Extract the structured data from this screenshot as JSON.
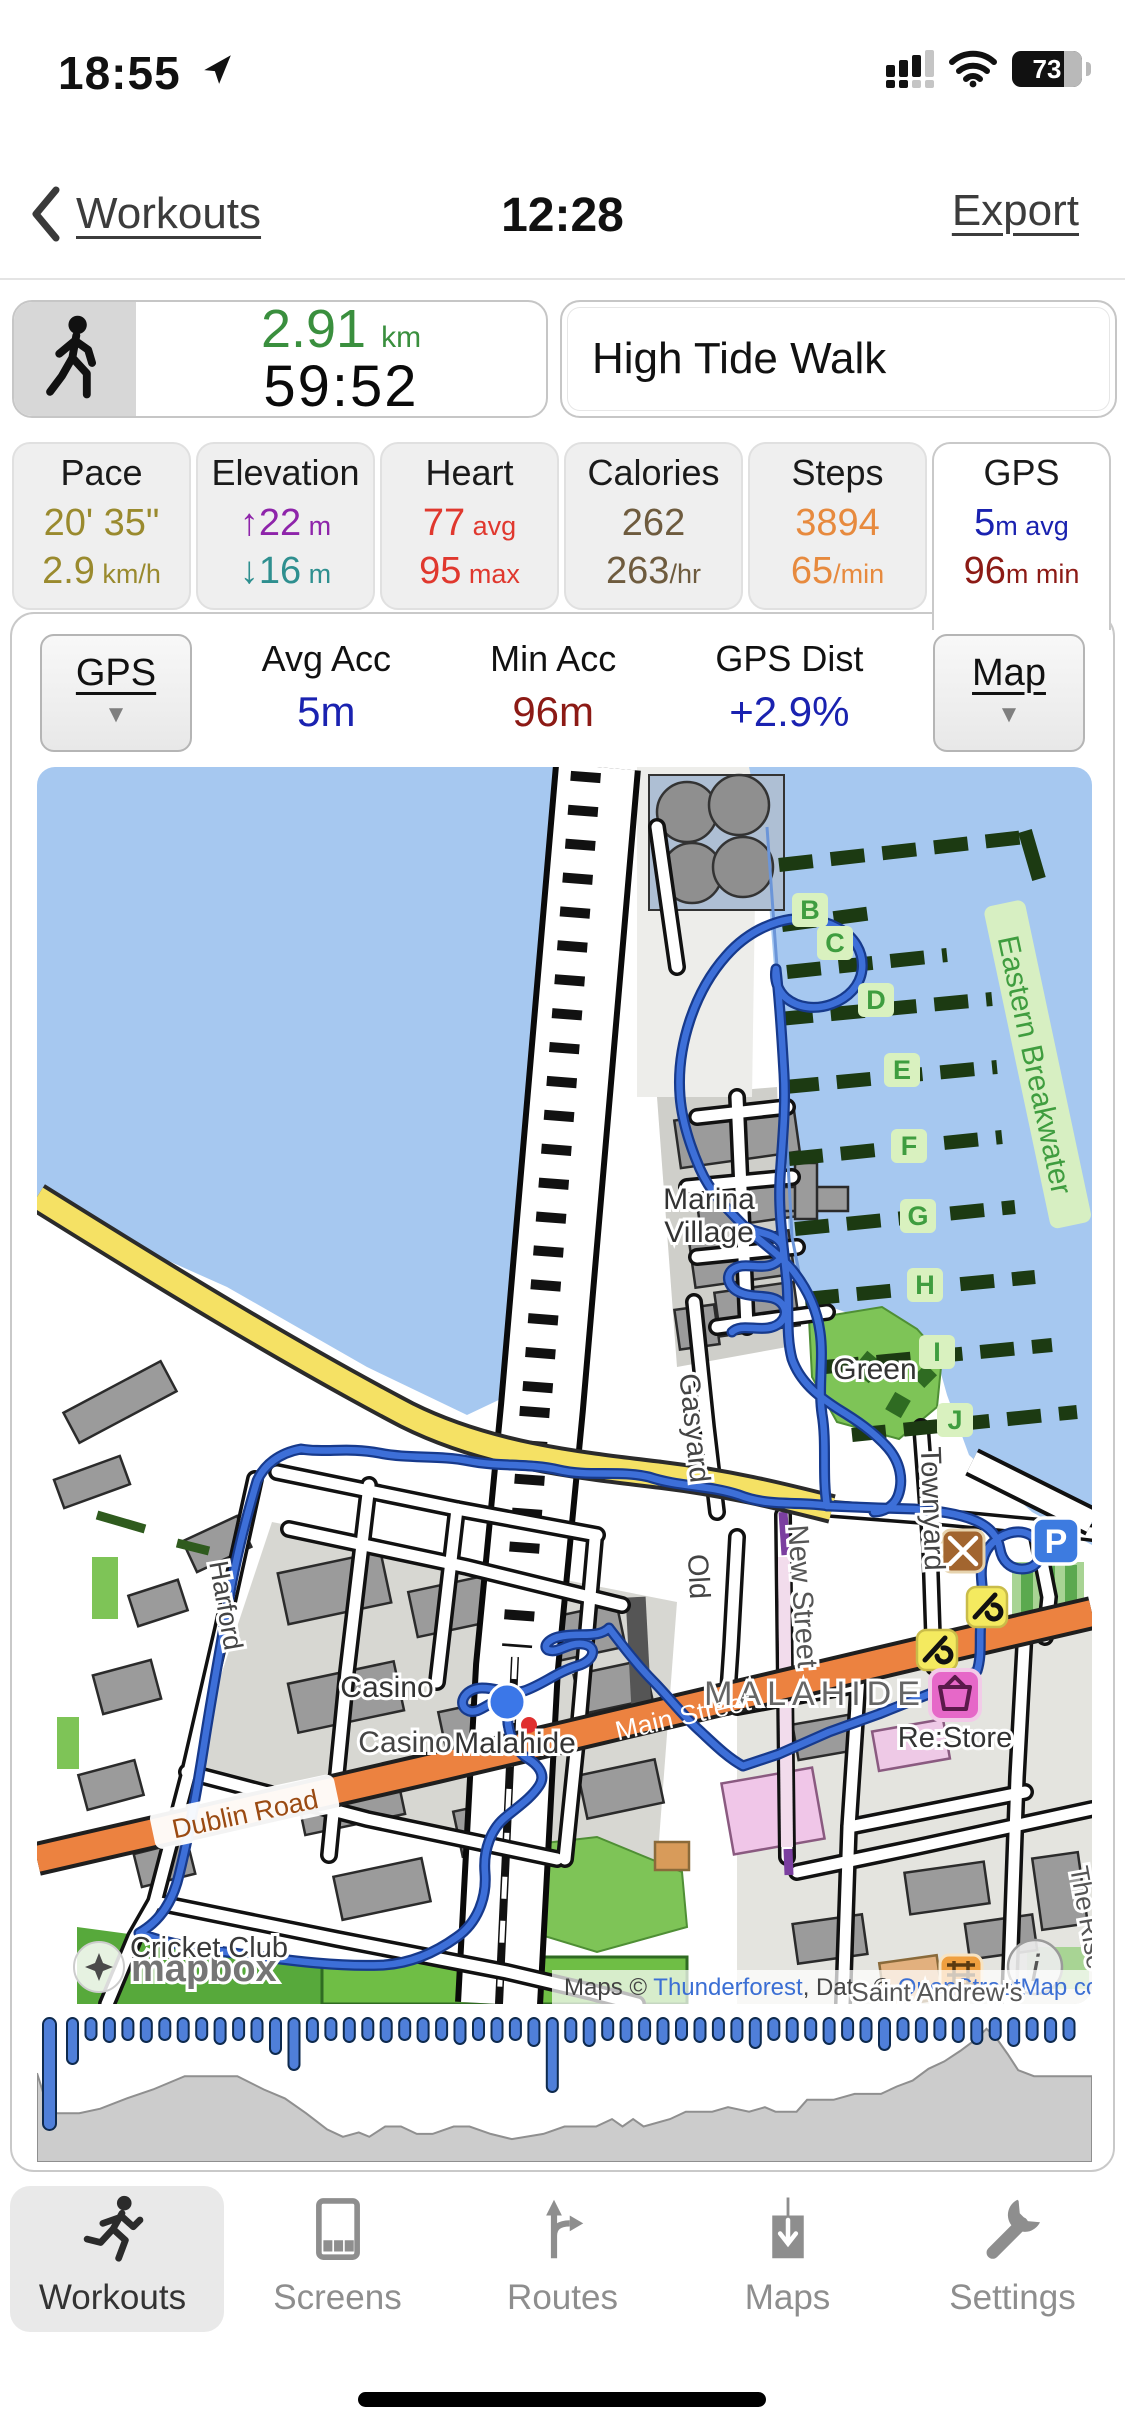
{
  "status_bar": {
    "time": "18:55",
    "battery": "73"
  },
  "nav": {
    "back_label": "Workouts",
    "title": "12:28",
    "export_label": "Export"
  },
  "summary": {
    "distance": "2.91",
    "distance_unit": "km",
    "duration": "59:52",
    "workout_title": "High Tide Walk"
  },
  "stats": [
    {
      "label": "Pace",
      "rows": [
        {
          "value": "20' 35\"",
          "unit": "",
          "color": "#9a8a2e"
        },
        {
          "value": "2.9",
          "unit": " km/h",
          "color": "#9a8a2e"
        }
      ],
      "selected": false
    },
    {
      "label": "Elevation",
      "rows": [
        {
          "value": "↑22",
          "unit": " m",
          "color": "#8e24aa"
        },
        {
          "value": "↓16",
          "unit": " m",
          "color": "#2e8f8f"
        }
      ],
      "selected": false
    },
    {
      "label": "Heart",
      "rows": [
        {
          "value": "77",
          "unit": " avg",
          "color": "#e0382e"
        },
        {
          "value": "95",
          "unit": " max",
          "color": "#e0382e"
        }
      ],
      "selected": false
    },
    {
      "label": "Calories",
      "rows": [
        {
          "value": "262",
          "unit": "",
          "color": "#6e5b3e"
        },
        {
          "value": "263",
          "unit": "/hr",
          "color": "#6e5b3e"
        }
      ],
      "selected": false
    },
    {
      "label": "Steps",
      "rows": [
        {
          "value": "3894",
          "unit": "",
          "color": "#e78a3e"
        },
        {
          "value": "65",
          "unit": "/min",
          "color": "#e78a3e"
        }
      ],
      "selected": false
    },
    {
      "label": "GPS",
      "rows": [
        {
          "value": "5",
          "unit": "m avg",
          "color": "#1a22b0"
        },
        {
          "value": "96",
          "unit": "m min",
          "color": "#8c1a15"
        }
      ],
      "selected": true
    }
  ],
  "controls": {
    "left_dropdown": "GPS",
    "right_dropdown": "Map",
    "caret": "▼",
    "items": [
      {
        "label": "Avg Acc",
        "value": "5m",
        "color": "#1a22b0"
      },
      {
        "label": "Min Acc",
        "value": "96m",
        "color": "#8c1a15"
      },
      {
        "label": "GPS Dist",
        "value": "+2.9%",
        "color": "#1a22b0"
      }
    ]
  },
  "map": {
    "logo": "mapbox",
    "attribution_parts": [
      {
        "t": "Maps © ",
        "c": "#444444"
      },
      {
        "t": "Thunderforest",
        "c": "#3b6fd4"
      },
      {
        "t": ", Data © ",
        "c": "#444444"
      },
      {
        "t": "OpenStreetMap contributors",
        "c": "#3b6fd4"
      }
    ],
    "marina_letters": [
      {
        "t": "B",
        "x": 773,
        "y": 152
      },
      {
        "t": "C",
        "x": 798,
        "y": 185
      },
      {
        "t": "D",
        "x": 839,
        "y": 242
      },
      {
        "t": "E",
        "x": 865,
        "y": 312
      },
      {
        "t": "F",
        "x": 872,
        "y": 388
      },
      {
        "t": "G",
        "x": 881,
        "y": 458
      },
      {
        "t": "H",
        "x": 888,
        "y": 527
      },
      {
        "t": "I",
        "x": 900,
        "y": 594
      },
      {
        "t": "J",
        "x": 918,
        "y": 662
      }
    ],
    "labels": [
      {
        "text": "Marina",
        "x": 672,
        "y": 442,
        "size": 30,
        "color": "#333333",
        "rot": 0
      },
      {
        "text": "Village",
        "x": 672,
        "y": 475,
        "size": 30,
        "color": "#333333",
        "rot": 0
      },
      {
        "text": "Green",
        "x": 838,
        "y": 612,
        "size": 30,
        "color": "#333333",
        "rot": 0
      },
      {
        "text": "Gasyard",
        "x": 648,
        "y": 662,
        "size": 29,
        "color": "#444444",
        "rot": 84
      },
      {
        "text": "Old",
        "x": 652,
        "y": 810,
        "size": 29,
        "color": "#444444",
        "rot": 87
      },
      {
        "text": "New Street",
        "x": 756,
        "y": 830,
        "size": 29,
        "color": "#555555",
        "rot": 86
      },
      {
        "text": "Townyard",
        "x": 886,
        "y": 742,
        "size": 29,
        "color": "#444444",
        "rot": 88
      },
      {
        "text": "Harford",
        "x": 180,
        "y": 840,
        "size": 27,
        "color": "#444444",
        "rot": 80
      },
      {
        "text": "Casino",
        "x": 350,
        "y": 930,
        "size": 30,
        "color": "#333333",
        "rot": 0
      },
      {
        "text": "Casino",
        "x": 368,
        "y": 985,
        "size": 30,
        "color": "#444444",
        "rot": 0
      },
      {
        "text": "Malahide",
        "x": 478,
        "y": 986,
        "size": 30,
        "color": "#333333",
        "rot": 0
      },
      {
        "text": "MALAHIDE",
        "x": 778,
        "y": 938,
        "size": 34,
        "color": "#666666",
        "rot": 0,
        "ls": 6
      },
      {
        "text": "Main Street",
        "x": 648,
        "y": 958,
        "size": 27,
        "color": "#ffffff",
        "rot": -13,
        "nohalo": true
      },
      {
        "text": "Dublin Road",
        "x": 210,
        "y": 1056,
        "size": 27,
        "color": "#9a4a12",
        "rot": -12,
        "bg": "#ffffff"
      },
      {
        "text": "Re:Store",
        "x": 918,
        "y": 980,
        "size": 29,
        "color": "#333333",
        "rot": 0
      },
      {
        "text": "Cricket Club",
        "x": 172,
        "y": 1190,
        "size": 29,
        "color": "#3a3a3a",
        "rot": 0
      },
      {
        "text": "Saint Andrew's",
        "x": 900,
        "y": 1234,
        "size": 26,
        "color": "#555555",
        "rot": 0
      },
      {
        "text": "The Rise",
        "x": 1042,
        "y": 1152,
        "size": 26,
        "color": "#555555",
        "rot": 80
      },
      {
        "text": "Eastern Breakwater",
        "x": 988,
        "y": 300,
        "size": 30,
        "color": "#3f9d3f",
        "rot": 78,
        "bg": "#d9f1bf"
      }
    ]
  },
  "chart_data": {
    "type": "area",
    "description": "Bottom strip: gray elevation profile area with blue GPS-accuracy capsule markers hanging from the top edge; tall first bar = worst accuracy sample",
    "elevation_profile": [
      [
        0,
        0.6
      ],
      [
        0.012,
        0.33
      ],
      [
        0.04,
        0.33
      ],
      [
        0.06,
        0.36
      ],
      [
        0.085,
        0.43
      ],
      [
        0.11,
        0.49
      ],
      [
        0.14,
        0.58
      ],
      [
        0.19,
        0.58
      ],
      [
        0.215,
        0.49
      ],
      [
        0.235,
        0.43
      ],
      [
        0.255,
        0.33
      ],
      [
        0.275,
        0.22
      ],
      [
        0.29,
        0.17
      ],
      [
        0.305,
        0.2
      ],
      [
        0.315,
        0.17
      ],
      [
        0.33,
        0.24
      ],
      [
        0.345,
        0.24
      ],
      [
        0.36,
        0.19
      ],
      [
        0.375,
        0.19
      ],
      [
        0.395,
        0.24
      ],
      [
        0.41,
        0.24
      ],
      [
        0.43,
        0.19
      ],
      [
        0.45,
        0.155
      ],
      [
        0.48,
        0.19
      ],
      [
        0.5,
        0.24
      ],
      [
        0.53,
        0.24
      ],
      [
        0.545,
        0.29
      ],
      [
        0.555,
        0.24
      ],
      [
        0.565,
        0.29
      ],
      [
        0.575,
        0.24
      ],
      [
        0.6,
        0.29
      ],
      [
        0.615,
        0.34
      ],
      [
        0.64,
        0.34
      ],
      [
        0.655,
        0.37
      ],
      [
        0.675,
        0.34
      ],
      [
        0.69,
        0.37
      ],
      [
        0.7,
        0.34
      ],
      [
        0.72,
        0.34
      ],
      [
        0.73,
        0.42
      ],
      [
        0.755,
        0.42
      ],
      [
        0.775,
        0.46
      ],
      [
        0.8,
        0.46
      ],
      [
        0.815,
        0.51
      ],
      [
        0.83,
        0.55
      ],
      [
        0.845,
        0.63
      ],
      [
        0.86,
        0.68
      ],
      [
        0.875,
        0.75
      ],
      [
        0.89,
        0.83
      ],
      [
        0.9,
        0.9
      ],
      [
        0.91,
        0.83
      ],
      [
        0.92,
        0.73
      ],
      [
        0.93,
        0.62
      ],
      [
        0.945,
        0.58
      ],
      [
        1,
        0.58
      ]
    ],
    "accuracy_marker_heights": [
      46,
      22,
      24,
      22,
      24,
      22,
      24,
      22,
      26,
      22,
      24,
      36,
      52,
      24,
      22,
      24,
      22,
      24,
      22,
      24,
      22,
      26,
      22,
      24,
      22,
      28,
      74,
      24,
      28,
      22,
      24,
      22,
      26,
      22,
      24,
      22,
      24,
      30,
      22,
      24,
      22,
      26,
      22,
      24,
      32,
      22,
      24,
      22,
      24,
      26,
      22,
      28,
      22,
      24,
      22
    ],
    "first_bar_height": 112
  },
  "tab_bar": [
    {
      "label": "Workouts",
      "icon": "runner-icon",
      "active": true
    },
    {
      "label": "Screens",
      "icon": "screens-icon",
      "active": false
    },
    {
      "label": "Routes",
      "icon": "routes-icon",
      "active": false
    },
    {
      "label": "Maps",
      "icon": "maps-icon",
      "active": false
    },
    {
      "label": "Settings",
      "icon": "settings-icon",
      "active": false
    }
  ],
  "colors": {
    "accent_green": "#3a8f3e",
    "route_blue": "#3d6fd8",
    "water_blue": "#a6c8f0"
  }
}
